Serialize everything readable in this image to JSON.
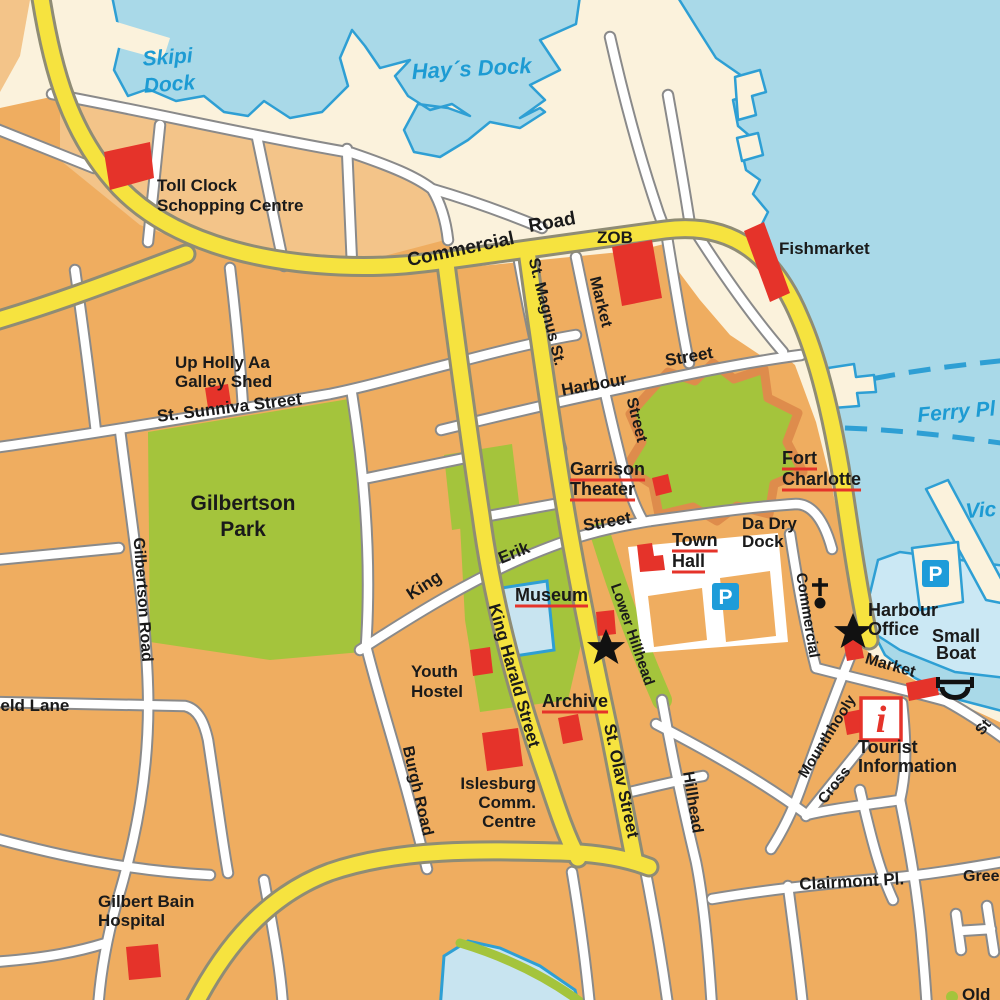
{
  "palette": {
    "sea": "#A9D9E8",
    "land": "#FBF2DC",
    "block": "#EFAD60",
    "block_light": "#F3C489",
    "park": "#A4C43C",
    "fort_wall": "#DE8C4C",
    "road_major": "#F6E33F",
    "road_minor": "#FFFFFF",
    "landmark_red": "#E5332A",
    "water_text": "#1D9BD3",
    "parking_blue": "#1E9CD9"
  },
  "icons": {
    "parking_label": "P",
    "tourist_info_label": "i"
  },
  "map": {
    "labels": [
      {
        "n": "skipi-dock",
        "t": [
          "Skipi",
          "Dock"
        ],
        "x": 168,
        "y": 64,
        "s": 21,
        "a": "m",
        "r": -4,
        "c": "w",
        "lh": 27
      },
      {
        "n": "hays-dock",
        "t": "Hay´s Dock",
        "x": 472,
        "y": 76,
        "s": 22,
        "a": "m",
        "r": -3,
        "c": "w"
      },
      {
        "n": "ferry-pier",
        "t": "Ferry Pl",
        "x": 918,
        "y": 422,
        "s": 21,
        "r": -5,
        "c": "w"
      },
      {
        "n": "victoria-pier",
        "t": "Vic",
        "x": 966,
        "y": 518,
        "s": 21,
        "r": -4,
        "c": "w"
      },
      {
        "n": "commercial-road-1",
        "t": "Commercial",
        "x": 462,
        "y": 255,
        "s": 19,
        "a": "m",
        "r": -12,
        "c": "s"
      },
      {
        "n": "commercial-road-2",
        "t": "Road",
        "x": 553,
        "y": 228,
        "s": 19,
        "a": "m",
        "r": -10,
        "c": "s"
      },
      {
        "n": "st-magnus-st",
        "t": "St. Magnus St.",
        "x": 542,
        "y": 313,
        "s": 16,
        "a": "m",
        "r": 76,
        "c": "s"
      },
      {
        "n": "market-street-1",
        "t": "Market",
        "x": 596,
        "y": 303,
        "s": 16,
        "a": "m",
        "r": 76,
        "c": "s"
      },
      {
        "n": "market-street-2",
        "t": "Street",
        "x": 632,
        "y": 421,
        "s": 16,
        "a": "m",
        "r": 76,
        "c": "s"
      },
      {
        "n": "harbour-street-1",
        "t": "Harbour",
        "x": 595,
        "y": 390,
        "s": 17,
        "a": "m",
        "r": -10,
        "c": "s"
      },
      {
        "n": "harbour-street-2",
        "t": "Street",
        "x": 690,
        "y": 362,
        "s": 17,
        "a": "m",
        "r": -10,
        "c": "s"
      },
      {
        "n": "king-erik-1",
        "t": "King",
        "x": 427,
        "y": 590,
        "s": 17,
        "a": "m",
        "r": -33,
        "c": "s"
      },
      {
        "n": "king-erik-2",
        "t": "Erik",
        "x": 516,
        "y": 558,
        "s": 17,
        "a": "m",
        "r": -22,
        "c": "s"
      },
      {
        "n": "king-erik-3",
        "t": "Street",
        "x": 608,
        "y": 527,
        "s": 17,
        "a": "m",
        "r": -10,
        "c": "s"
      },
      {
        "n": "king-harald-street",
        "t": "King Harald Street",
        "x": 509,
        "y": 677,
        "s": 17,
        "a": "m",
        "r": 74,
        "c": "s"
      },
      {
        "n": "st-olav-street",
        "t": "St. Olav Street",
        "x": 616,
        "y": 782,
        "s": 17,
        "a": "m",
        "r": 78,
        "c": "s"
      },
      {
        "n": "lower-hillhead",
        "t": "Lower Hillhead",
        "x": 628,
        "y": 636,
        "s": 15,
        "a": "m",
        "r": 71,
        "c": "s"
      },
      {
        "n": "hillhead",
        "t": "Hillhead",
        "x": 688,
        "y": 803,
        "s": 16,
        "a": "m",
        "r": 81,
        "c": "s"
      },
      {
        "n": "burgh-road",
        "t": "Burgh Road",
        "x": 413,
        "y": 792,
        "s": 16,
        "a": "m",
        "r": 77,
        "c": "s"
      },
      {
        "n": "gilbertson-road",
        "t": "Gilbertson Road",
        "x": 138,
        "y": 600,
        "s": 16,
        "a": "m",
        "r": 86,
        "c": "s"
      },
      {
        "n": "st-sunniva-street",
        "t": "St. Sunniva Street",
        "x": 230,
        "y": 413,
        "s": 17,
        "a": "m",
        "r": -7,
        "c": "s"
      },
      {
        "n": "field-lane",
        "t": "field Lane",
        "x": -10,
        "y": 711,
        "s": 17,
        "c": "s"
      },
      {
        "n": "commercial-street",
        "t": "Commercial",
        "x": 803,
        "y": 616,
        "s": 15,
        "a": "m",
        "r": 81,
        "c": "s"
      },
      {
        "n": "market-lower",
        "t": "Market",
        "x": 889,
        "y": 670,
        "s": 16,
        "a": "m",
        "r": 16,
        "c": "s"
      },
      {
        "n": "mounthhooly",
        "t": "Mounthhooly",
        "x": 831,
        "y": 739,
        "s": 15,
        "a": "m",
        "r": -58,
        "c": "s"
      },
      {
        "n": "cross",
        "t": "Cross",
        "x": 838,
        "y": 788,
        "s": 15,
        "a": "m",
        "r": -52,
        "c": "s"
      },
      {
        "n": "clairmont-pl",
        "t": "Clairmont Pl.",
        "x": 852,
        "y": 887,
        "s": 17,
        "a": "m",
        "r": -3,
        "c": "s"
      },
      {
        "n": "gree",
        "t": "Gree",
        "x": 963,
        "y": 881,
        "s": 16,
        "c": "s"
      },
      {
        "n": "old",
        "t": "Old",
        "x": 962,
        "y": 1000,
        "s": 17,
        "c": "s"
      },
      {
        "n": "st-edge",
        "t": "St",
        "x": 982,
        "y": 736,
        "s": 15,
        "r": -50,
        "c": "s"
      },
      {
        "n": "toll-clock",
        "t": [
          "Toll Clock",
          "Schopping Centre"
        ],
        "x": 157,
        "y": 191,
        "s": 17,
        "lh": 20,
        "c": "l"
      },
      {
        "n": "zob",
        "t": "ZOB",
        "x": 597,
        "y": 243,
        "s": 17,
        "c": "l"
      },
      {
        "n": "fishmarket",
        "t": "Fishmarket",
        "x": 779,
        "y": 254,
        "s": 17,
        "c": "l"
      },
      {
        "n": "up-holly-aa",
        "t": [
          "Up Holly Aa",
          "Galley Shed"
        ],
        "x": 175,
        "y": 368,
        "s": 17,
        "lh": 19,
        "c": "l"
      },
      {
        "n": "garrison-theater",
        "t": [
          "Garrison",
          "Theater"
        ],
        "x": 570,
        "y": 475,
        "s": 18,
        "lh": 20,
        "u": true,
        "c": "l"
      },
      {
        "n": "fort-charlotte",
        "t": [
          "Fort",
          "Charlotte"
        ],
        "x": 782,
        "y": 464,
        "s": 18,
        "lh": 21,
        "u": true,
        "c": "l"
      },
      {
        "n": "da-dry-dock",
        "t": [
          "Da Dry",
          "Dock"
        ],
        "x": 742,
        "y": 529,
        "s": 17,
        "lh": 18,
        "c": "l"
      },
      {
        "n": "town-hall",
        "t": [
          "Town",
          "Hall"
        ],
        "x": 672,
        "y": 546,
        "s": 18,
        "lh": 21,
        "u": true,
        "c": "l"
      },
      {
        "n": "museum",
        "t": "Museum",
        "x": 515,
        "y": 601,
        "s": 18,
        "u": true,
        "c": "l"
      },
      {
        "n": "youth-hostel",
        "t": [
          "Youth",
          "Hostel"
        ],
        "x": 411,
        "y": 677,
        "s": 17,
        "lh": 20,
        "c": "l"
      },
      {
        "n": "archive",
        "t": "Archive",
        "x": 542,
        "y": 707,
        "s": 18,
        "u": true,
        "c": "l"
      },
      {
        "n": "islesburg",
        "t": [
          "Islesburg",
          "Comm.",
          "Centre"
        ],
        "x": 536,
        "y": 789,
        "s": 17,
        "lh": 19,
        "a": "e",
        "c": "l"
      },
      {
        "n": "gilbert-bain",
        "t": [
          "Gilbert Bain",
          "Hospital"
        ],
        "x": 98,
        "y": 907,
        "s": 17,
        "lh": 19,
        "c": "l"
      },
      {
        "n": "harbour-office",
        "t": [
          "Harbour",
          "Office"
        ],
        "x": 868,
        "y": 616,
        "s": 18,
        "lh": 19,
        "c": "l"
      },
      {
        "n": "small-boat",
        "t": [
          "Small",
          "Boat"
        ],
        "x": 956,
        "y": 642,
        "s": 18,
        "lh": 17,
        "a": "m",
        "c": "l"
      },
      {
        "n": "tourist-information",
        "t": [
          "Tourist",
          "Information"
        ],
        "x": 858,
        "y": 753,
        "s": 18,
        "lh": 19,
        "c": "l"
      },
      {
        "n": "gilbertson-park",
        "t": [
          "Gilbertson",
          "Park"
        ],
        "x": 243,
        "y": 510,
        "s": 21,
        "lh": 26,
        "a": "m",
        "c": "p"
      }
    ]
  }
}
